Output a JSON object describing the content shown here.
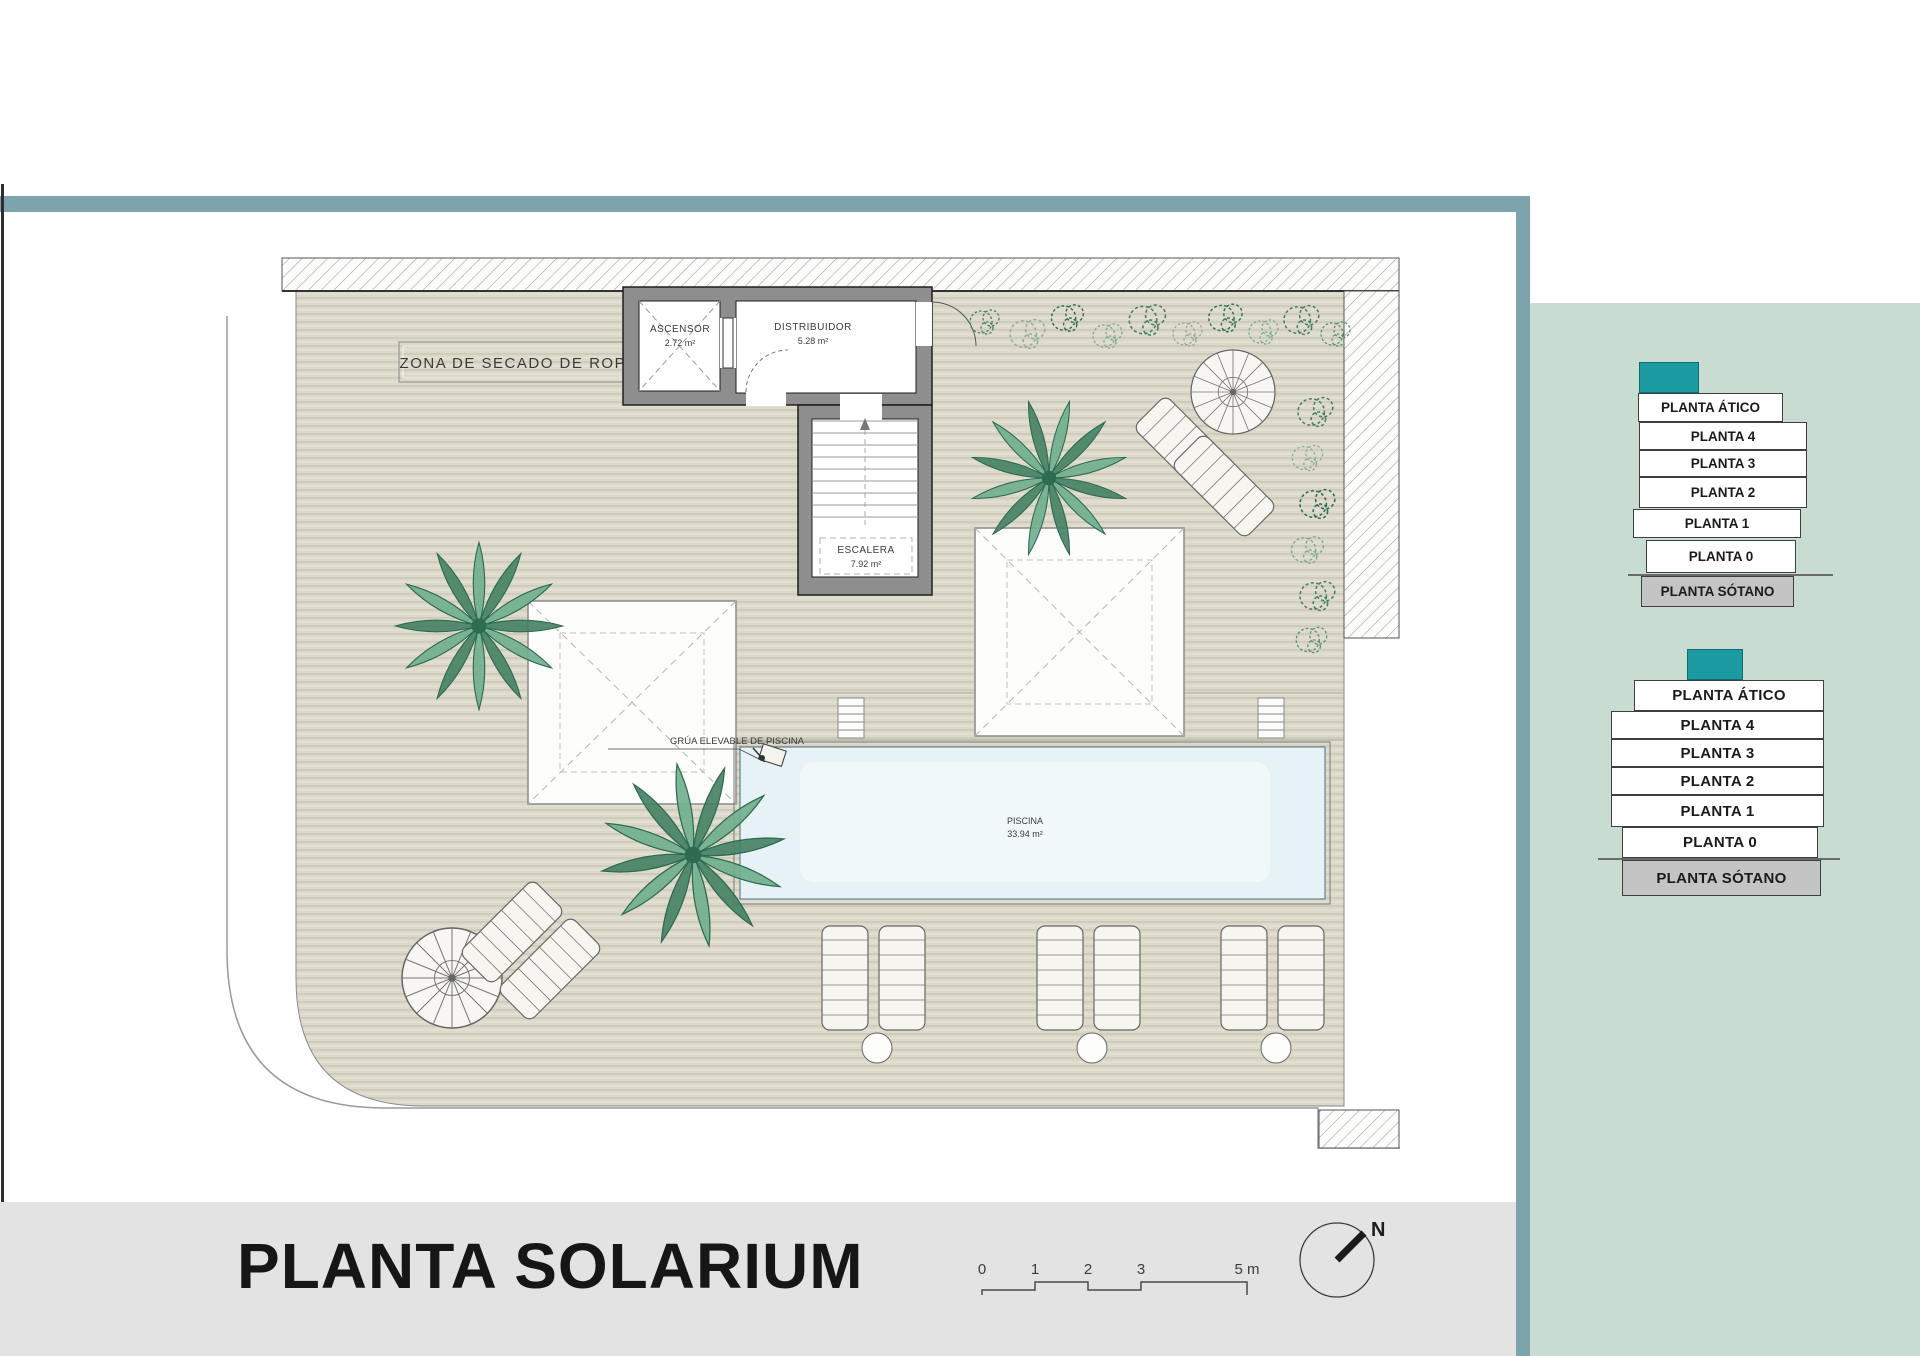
{
  "plan": {
    "title": "PLANTA SOLARIUM",
    "north": "N",
    "labels": {
      "zona_secado": "ZONA DE SECADO DE ROPA",
      "grua": "GRÚA ELEVABLE DE PISCINA"
    },
    "rooms": {
      "ascensor": {
        "name": "ASCENSOR",
        "area": "2.72 m²"
      },
      "distribuidor": {
        "name": "DISTRIBUIDOR",
        "area": "5.28 m²"
      },
      "escalera": {
        "name": "ESCALERA",
        "area": "7.92 m²"
      },
      "piscina": {
        "name": "PISCINA",
        "area": "33.94 m²"
      }
    },
    "scale_ticks": [
      "0",
      "1",
      "2",
      "3",
      "5 m"
    ]
  },
  "floor_selector_top": {
    "levels": [
      "PLANTA ÁTICO",
      "PLANTA 4",
      "PLANTA 3",
      "PLANTA 2",
      "PLANTA 1",
      "PLANTA 0",
      "PLANTA SÓTANO"
    ]
  },
  "floor_selector_bottom": {
    "levels": [
      "PLANTA ÁTICO",
      "PLANTA 4",
      "PLANTA 3",
      "PLANTA 2",
      "PLANTA 1",
      "PLANTA 0",
      "PLANTA SÓTANO"
    ]
  },
  "colors": {
    "frame_teal": "#7da4ad",
    "panel_green": "#c8dcd2",
    "selected_teal": "#1b9aa2",
    "pool_blue": "#e7f2f6",
    "deck_tan": "#dcd9cb",
    "wall_gray": "#8e8e8e",
    "footer_gray": "#e3e3e3"
  }
}
